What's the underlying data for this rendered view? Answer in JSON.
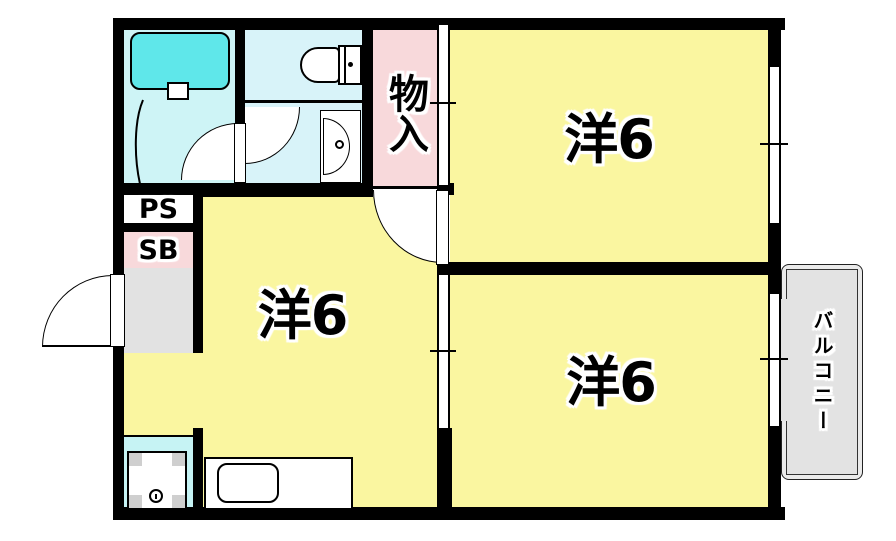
{
  "floorplan": {
    "title": "2K apartment floor plan",
    "rooms": {
      "western_top_right": {
        "label": "洋6"
      },
      "western_middle": {
        "label": "洋6"
      },
      "western_bottom_right": {
        "label": "洋6"
      },
      "storage": {
        "label": "物入"
      },
      "pipe_space": {
        "label": "PS"
      },
      "shoe_box": {
        "label": "SB"
      },
      "balcony": {
        "label": "バルコニー"
      }
    },
    "colors": {
      "room_yellow": "#FAF6A0",
      "closet_pink": "#F8D9DB",
      "bath_cyan": "#CEF4F6",
      "toilet_cyan": "#D8F3F9",
      "laundry_cyan": "#C6F3F4",
      "tub_cyan": "#5FE7EA",
      "entry_gray": "#E2E2E2",
      "balcony_gray": "#EBEBEB",
      "balcony_inner_gray": "#E3E3E3",
      "wall": "#000000"
    },
    "fixtures": [
      "bathtub",
      "toilet",
      "washbasin",
      "kitchen-sink",
      "washing-machine-pan",
      "entry-door",
      "hinged-doors",
      "sliding-windows"
    ]
  }
}
